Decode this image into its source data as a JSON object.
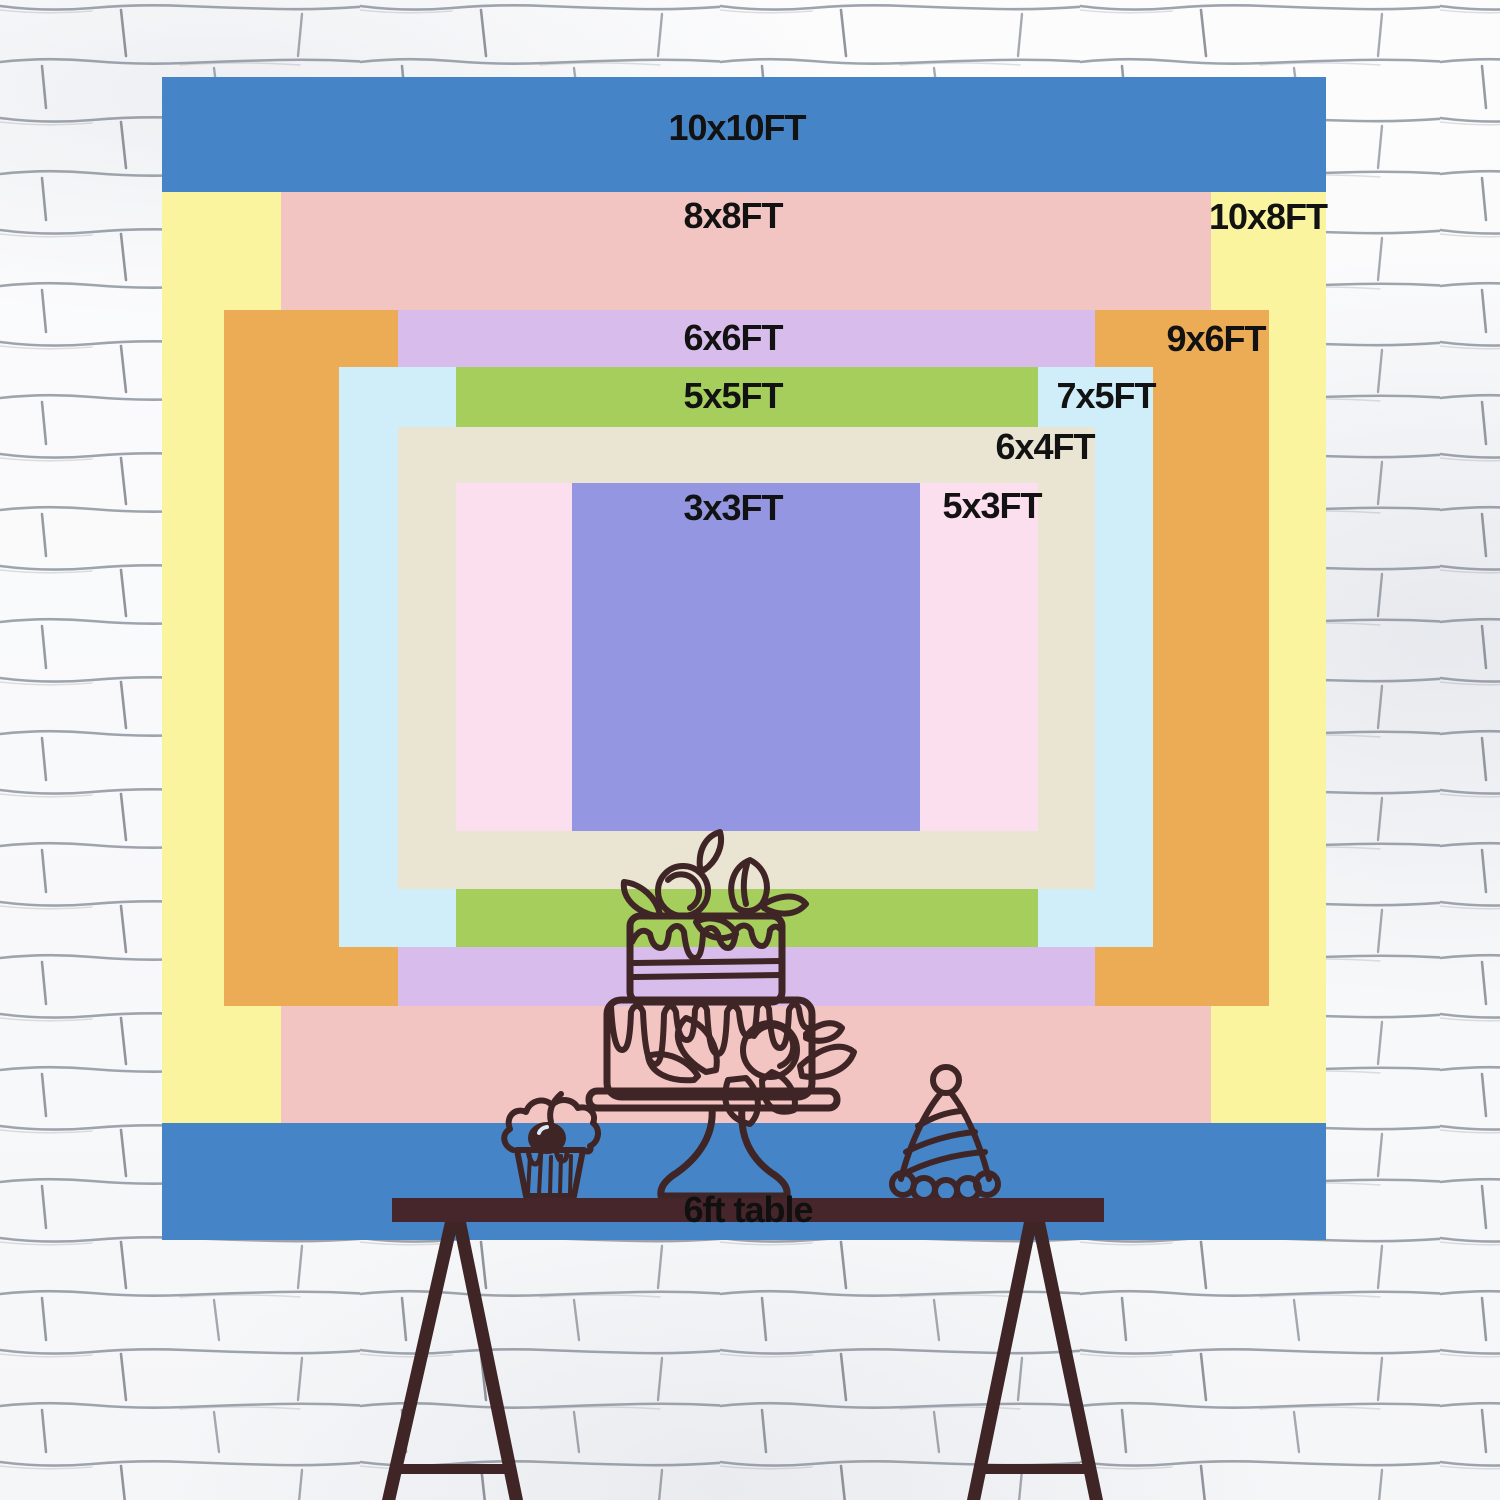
{
  "title": "Backdrop size comparison chart",
  "wall": {
    "base_color": "#fbfbfc",
    "brick_line_color": "#878e99",
    "brick_tick_color": "#6d737d"
  },
  "backdrops": [
    {
      "label": "10x10FT",
      "color": "#4584c7",
      "x": 162,
      "y": 77,
      "w": 1164,
      "h": 1163,
      "lx": 737,
      "ly": 128
    },
    {
      "label": "10x8FT",
      "color": "#fbf49e",
      "x": 162,
      "y": 192,
      "w": 1164,
      "h": 931,
      "lx": 1268,
      "ly": 217
    },
    {
      "label": "8x8FT",
      "color": "#f3c5c2",
      "x": 281,
      "y": 192,
      "w": 930,
      "h": 931,
      "lx": 733,
      "ly": 216
    },
    {
      "label": "9x6FT",
      "color": "#ecab55",
      "x": 224,
      "y": 310,
      "w": 1045,
      "h": 696,
      "lx": 1216,
      "ly": 339
    },
    {
      "label": "6x6FT",
      "color": "#d8bceb",
      "x": 398,
      "y": 310,
      "w": 697,
      "h": 696,
      "lx": 733,
      "ly": 338
    },
    {
      "label": "7x5FT",
      "color": "#cfeefa",
      "x": 339,
      "y": 367,
      "w": 814,
      "h": 580,
      "lx": 1106,
      "ly": 396
    },
    {
      "label": "5x5FT",
      "color": "#a6ce5c",
      "x": 456,
      "y": 367,
      "w": 582,
      "h": 580,
      "lx": 733,
      "ly": 396
    },
    {
      "label": "6x4FT",
      "color": "#eae4d3",
      "x": 398,
      "y": 427,
      "w": 697,
      "h": 462,
      "lx": 1045,
      "ly": 447
    },
    {
      "label": "5x3FT",
      "color": "#fcdfef",
      "x": 456,
      "y": 483,
      "w": 582,
      "h": 348,
      "lx": 992,
      "ly": 506
    },
    {
      "label": "3x3FT",
      "color": "#9496e1",
      "x": 572,
      "y": 483,
      "w": 348,
      "h": 348,
      "lx": 733,
      "ly": 508
    }
  ],
  "table": {
    "label": "6ft table",
    "color": "#46262a"
  },
  "illustrations": {
    "line_color": "#3f2526",
    "items": [
      "two-tier cake on stand",
      "cupcake with cherry",
      "party hat"
    ]
  }
}
